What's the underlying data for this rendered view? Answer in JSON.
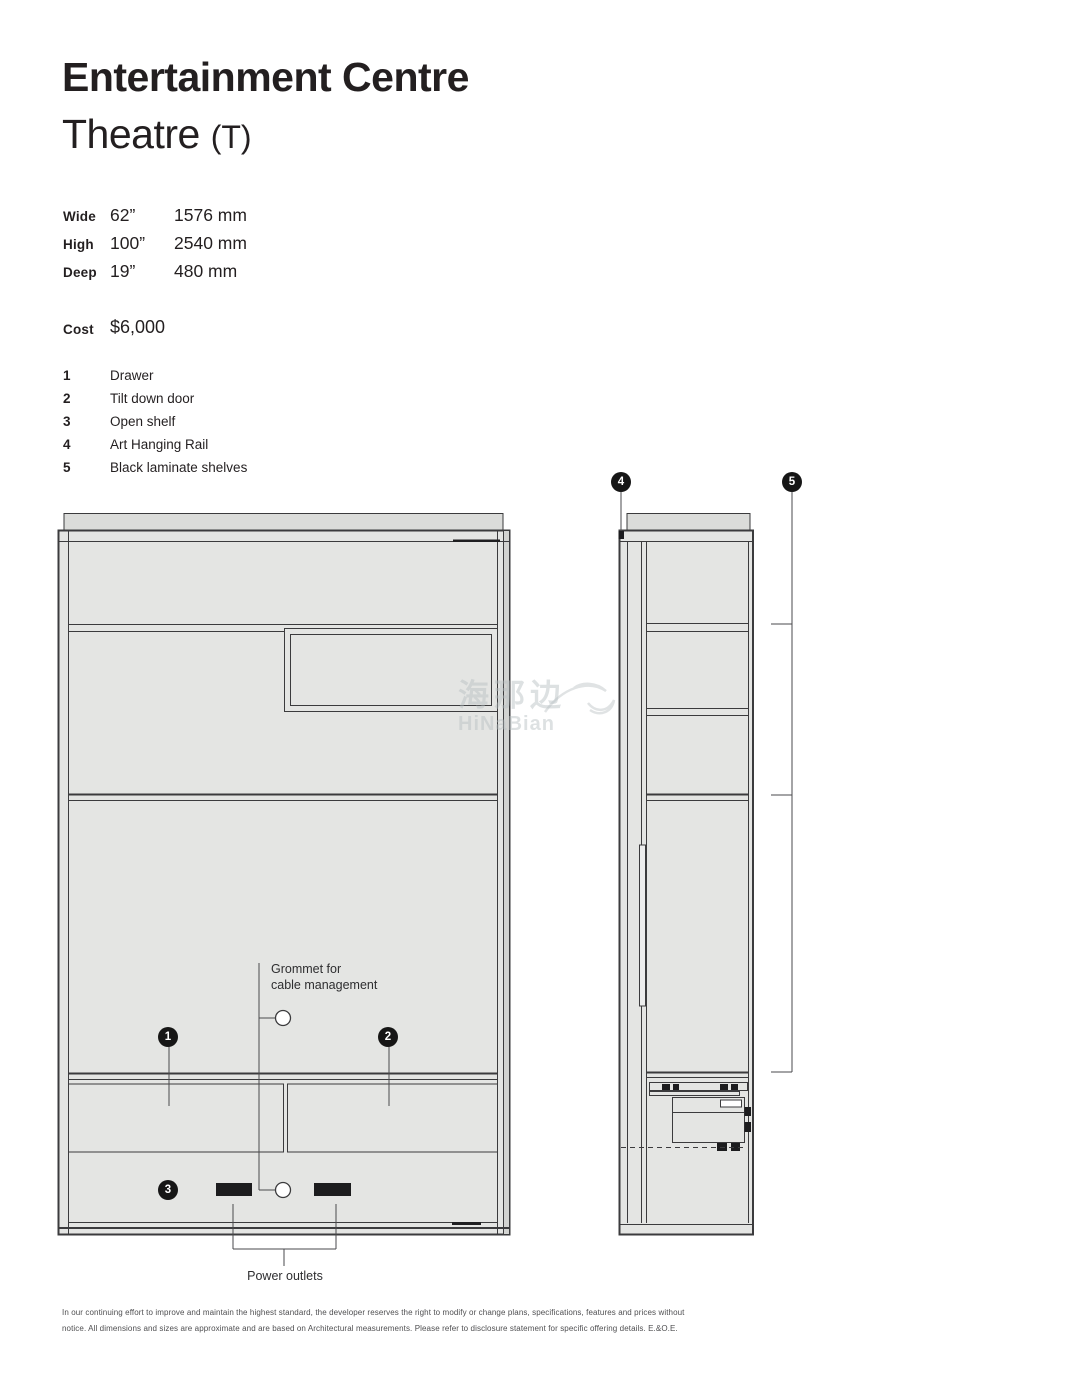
{
  "title": {
    "line1": "Entertainment Centre",
    "line2": "Theatre",
    "line2_suffix": "(T)"
  },
  "specs": {
    "rows": [
      {
        "label": "Wide",
        "imperial": "62”",
        "metric": "1576 mm"
      },
      {
        "label": "High",
        "imperial": "100”",
        "metric": "2540 mm"
      },
      {
        "label": "Deep",
        "imperial": "19”",
        "metric": "480 mm"
      }
    ],
    "cost_label": "Cost",
    "cost_value": "$6,000"
  },
  "features": [
    {
      "num": "1",
      "label": "Drawer"
    },
    {
      "num": "2",
      "label": "Tilt down door"
    },
    {
      "num": "3",
      "label": "Open shelf"
    },
    {
      "num": "4",
      "label": "Art Hanging Rail"
    },
    {
      "num": "5",
      "label": "Black laminate shelves"
    }
  ],
  "drawing": {
    "callouts": [
      {
        "num": "1"
      },
      {
        "num": "2"
      },
      {
        "num": "3"
      },
      {
        "num": "4"
      },
      {
        "num": "5"
      }
    ],
    "grommet_line1": "Grommet for",
    "grommet_line2": "cable management",
    "power_outlets": "Power outlets"
  },
  "watermark": {
    "cn": "海那边",
    "en": "HiNaBian"
  },
  "footer": {
    "line1": "In our continuing effort to improve and maintain the highest standard, the developer reserves the right to modify or change plans, specifications, features and prices without",
    "line2": "notice. All dimensions and sizes are approximate and are based on Architectural measurements. Please refer to disclosure statement for specific offering details. E.&O.E."
  },
  "colors": {
    "line": "#3b3b3d",
    "panel_fill": "#e4e5e3",
    "cap_fill": "#dbdcda",
    "shade_fill": "#d2d3d1",
    "black_detail": "#1c1c1e",
    "watermark": "#b6bec1"
  }
}
